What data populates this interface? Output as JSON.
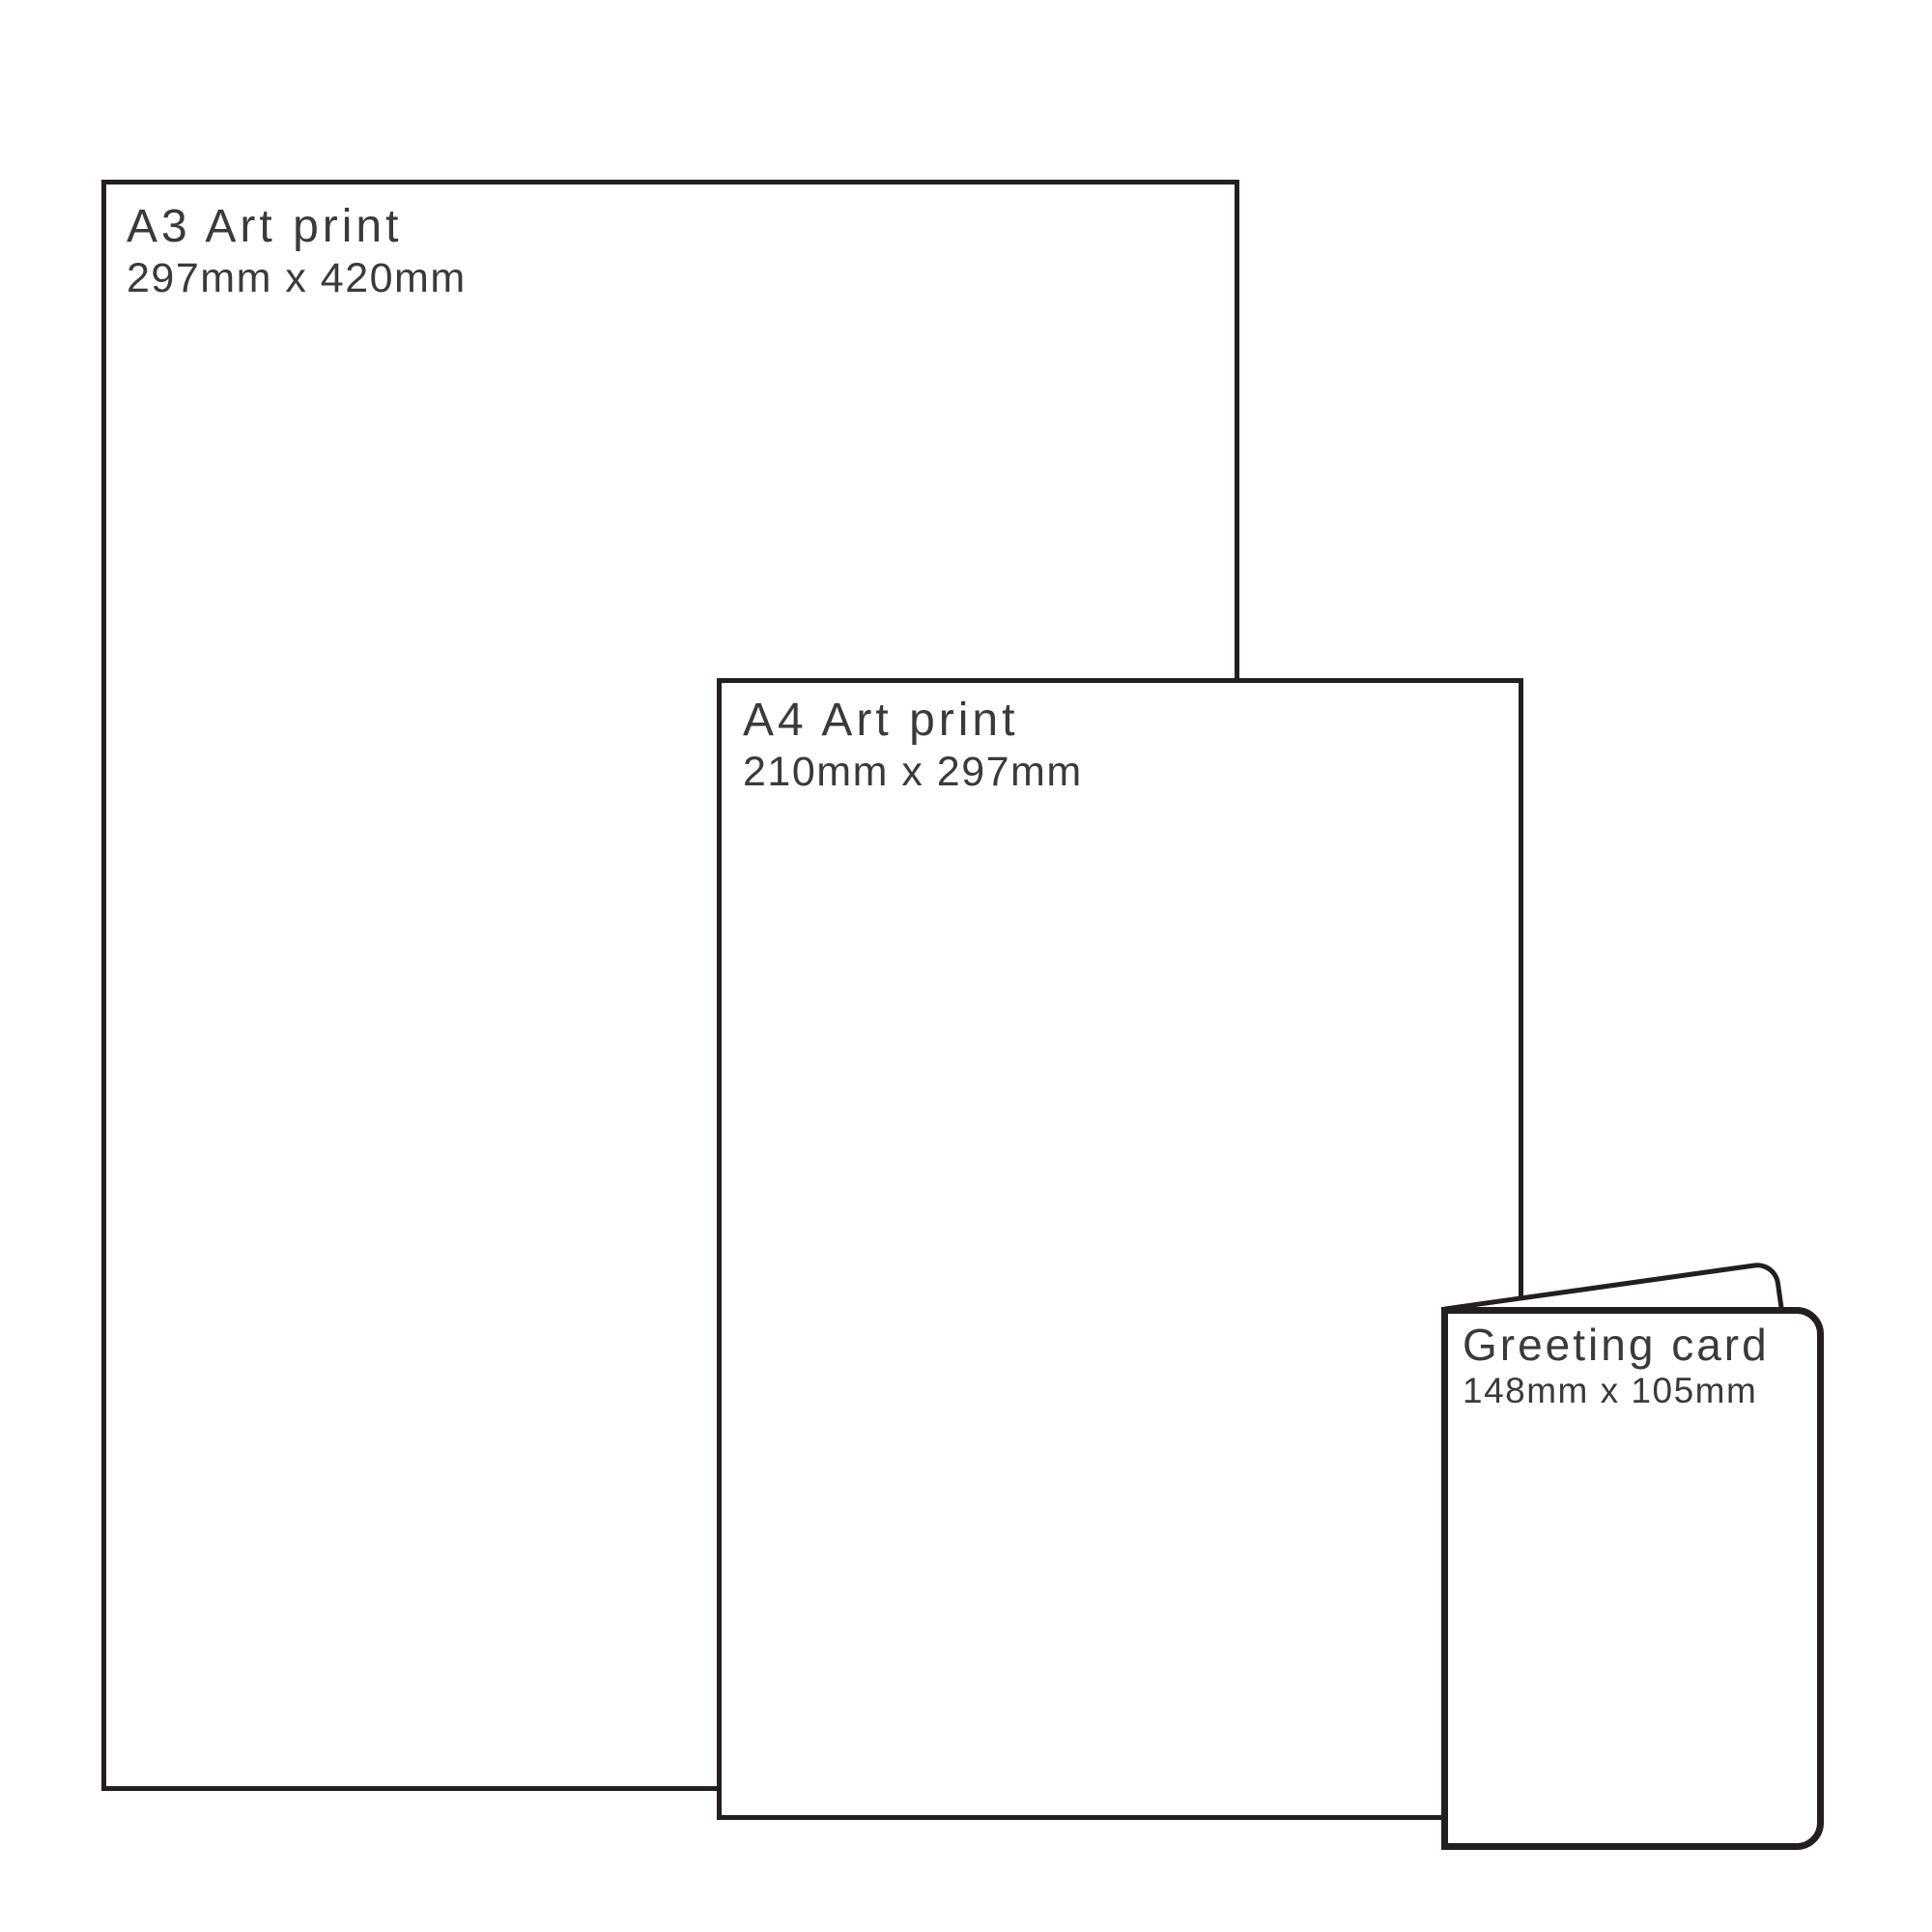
{
  "diagram": {
    "title": "Print size comparison",
    "items": [
      {
        "id": "a3-print",
        "title": "A3 Art print",
        "dimensions": "297mm x 420mm"
      },
      {
        "id": "a4-print",
        "title": "A4 Art print",
        "dimensions": "210mm x 297mm"
      },
      {
        "id": "greeting-card",
        "title": "Greeting card",
        "dimensions": "148mm x 105mm"
      }
    ],
    "colors": {
      "outline": "#231f20",
      "text": "#3a3a3a",
      "background": "#ffffff"
    }
  }
}
